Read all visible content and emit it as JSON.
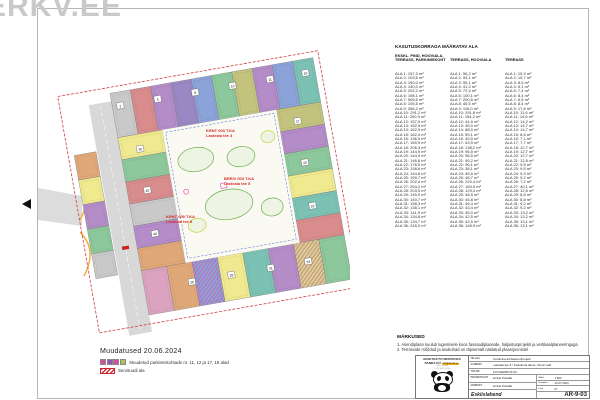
{
  "watermark": "ERKV.EE",
  "area_table": {
    "title": "KASUTUSKORRAGA MÄÄRATAV ALA",
    "row_prefix": "ALA",
    "unit": "m²",
    "columns": [
      {
        "header": [
          "EKSKL. PIND, HOOVIALA,",
          "TERRASS, PARKIMISKOHT"
        ],
        "values": [
          "157,3",
          "103,6",
          "150,0",
          "140,0",
          "202,2",
          "198,1",
          "505,5",
          "105,5",
          "266,2",
          "291,2",
          "200,9",
          "157,9",
          "152,9",
          "162,9",
          "162,4",
          "136,5",
          "169,9",
          "206,3",
          "144,9",
          "144,9",
          "146,6",
          "176,5",
          "138,6",
          "144,8",
          "159,7",
          "202,4",
          "254,2",
          "203,5",
          "145,0",
          "140,7",
          "158,3",
          "138,1",
          "141,9",
          "134,8",
          "134,7",
          "245,0"
        ]
      },
      {
        "header": [
          "",
          "TERRASS, HOOVIALA"
        ],
        "values": [
          "56,2",
          "53,1",
          "55,1",
          "41,2",
          "72,4",
          "100,1",
          "200,6",
          "45,5",
          "116,0",
          "291,8",
          "154,2",
          "44,9",
          "45,0",
          "88,0",
          "59,1",
          "49,5",
          "43,9",
          "138,2",
          "96,5",
          "96,5",
          "46,2",
          "96,1",
          "38,1",
          "45,5",
          "48,7",
          "220,4",
          "184,0",
          "129,4",
          "48,5",
          "45,8",
          "46,4",
          "43,4",
          "45,0",
          "42,5",
          "42,5",
          "149,9"
        ]
      },
      {
        "header": [
          "",
          "TERRASS"
        ],
        "values": [
          "15,9",
          "15,7",
          "8,5",
          "6,1",
          "7,4",
          "8,4",
          "6,5",
          "8,4",
          "17,6",
          "11,6",
          "14,6",
          "14,2",
          "14,7",
          "14,7",
          "8,6",
          "7,1",
          "7,7",
          "12,7",
          "12,7",
          "12,7",
          "12,5",
          "9,5",
          "9,5",
          "9,3",
          "9,2",
          "7,2",
          "40,1",
          "12,5",
          "8,6",
          "8,8",
          "9,2",
          "9,2",
          "13,2",
          "13,2",
          "13,1",
          "13,1"
        ]
      }
    ]
  },
  "changes": {
    "title": "Muudatused 20.06.2024",
    "items": [
      {
        "type": "squares",
        "swatches": [
          "#d94fa0",
          "#8f5bb5",
          "#d94fa0",
          "#a8c05a"
        ],
        "label": "Muudetud parkimiskohtade nr. 11, 12 ja 17, 18 alad"
      },
      {
        "type": "hatch",
        "color": "#d03030",
        "label": "Servituudi ala"
      }
    ]
  },
  "notes": {
    "title": "MÄRKUSED",
    "items": [
      "1. Asendiplaan kuulub lugemisele koos fassaadiplaanide, haljastusprojekti ja vertikaalplaneeringuga",
      "2. Terrasside mõõdud ja asukohad on täpsemalt näidatud plaanijoonistel"
    ]
  },
  "title_block": {
    "company_line1": "ARHITEKTUURIBÜROO",
    "company_line2": "PANDA OÜ",
    "company_contact": "info@panda.ee",
    "address_line1": "Tallinn, Eesti",
    "address_line2": "+372 5555 5555",
    "fields": [
      {
        "label": "Tellija",
        "value": "Kodulinna arhitektuuriprojekt"
      },
      {
        "label": "Aadress",
        "value": "Lasteaia tee 5 / Kodulinna tänav, Viimsi vald"
      },
      {
        "label": "Töö nr",
        "value": "A-KOHENDUS 03"
      }
    ],
    "people": [
      {
        "label": "Projektijuht",
        "value": "Andrei Poluäär"
      },
      {
        "label": "Arhitekt",
        "value": "Andrei Poluäär"
      }
    ],
    "meta": [
      {
        "label": "Mõõt",
        "value": "1:500"
      },
      {
        "label": "Kuupäev",
        "value": "10.07.2024"
      },
      {
        "label": "Leht",
        "value": "07"
      }
    ],
    "sheet_title": "Eskiislahend",
    "sheet_code": "AR-9-03"
  },
  "plan": {
    "boundary_color": "#d04040",
    "road_color": "#d8d8d8",
    "curb_color": "#f5a933",
    "landscape_color": "#6ab04c",
    "change_hatch_color": "#d94fa0",
    "servitude_hatch_color": "#d03030",
    "wings": {
      "top": {
        "colors": [
          "#c9c9c9",
          "#d98c8c",
          "#b48cc8",
          "#9a88c4",
          "#8ca3d9",
          "#8cc89b",
          "#c3c37e",
          "#b48cc8",
          "#8ca3d9",
          "#7cc2b4"
        ]
      },
      "right": {
        "colors": [
          "#c3c37e",
          "#b48cc8",
          "#8cc89b",
          "#efe98f",
          "#7cc2b4",
          "#d98c8c"
        ]
      },
      "bottom": {
        "colors": [
          "#dba3c0",
          "#e0a878",
          "#8ca3d9",
          "#efe98f",
          "#7cc2b4",
          "#b48cc8",
          "#d3d988",
          "#8cc89b"
        ]
      },
      "left": {
        "colors": [
          "#efe98f",
          "#8cc89b",
          "#d98c8c",
          "#c9c9c9",
          "#b48cc8",
          "#e0a878"
        ]
      },
      "west_strip": {
        "colors": [
          "#e0a878",
          "#efe98f",
          "#b48cc8",
          "#8cc89b",
          "#c9c9c9"
        ]
      }
    },
    "badge_numbers": [
      "2",
      "5",
      "8",
      "10",
      "11",
      "16",
      "17",
      "20",
      "22",
      "26",
      "28",
      "31",
      "34",
      "36",
      "40",
      "46"
    ],
    "annotations": [
      {
        "line1": "KRNT 003 T.KA",
        "line2": "Lasteaia tee 3"
      },
      {
        "line1": "BREIV 003 T.KA",
        "line2": "Lasteaia tee 5"
      },
      {
        "line1": "KRNT 005 T.KA",
        "line2": "Lasteaia tee 8"
      }
    ]
  }
}
